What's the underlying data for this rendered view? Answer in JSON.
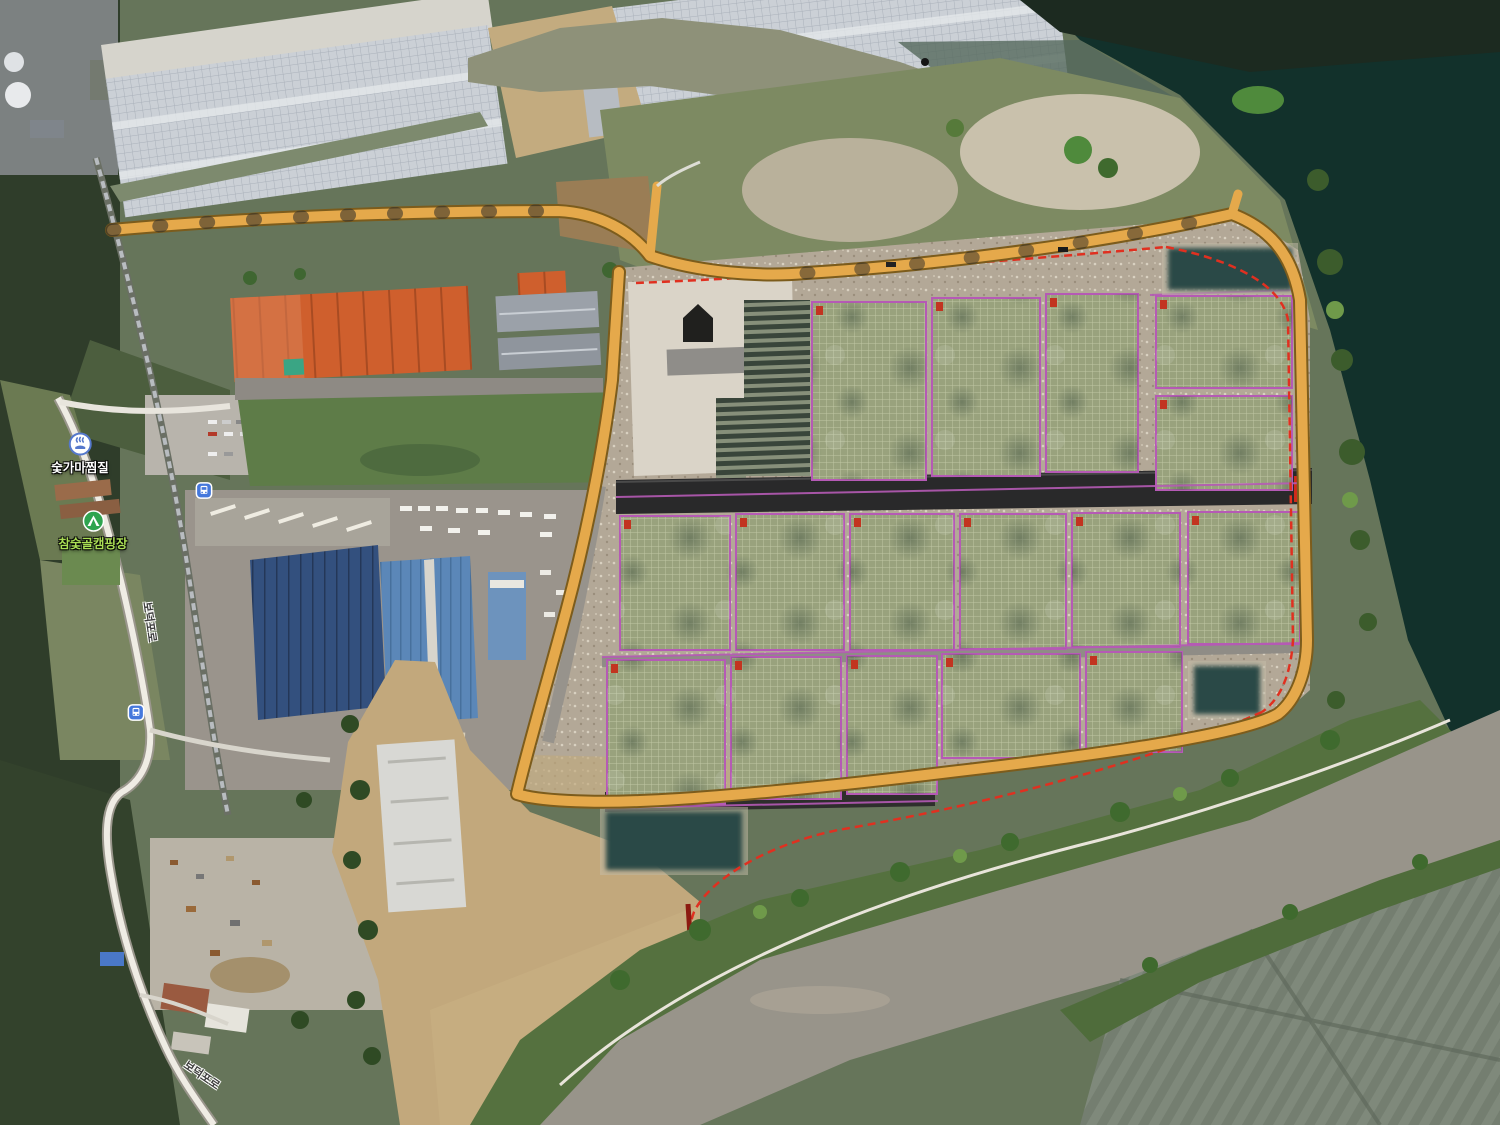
{
  "map": {
    "view": "satellite-orthophoto",
    "poi_labels": [
      {
        "id": "sauna",
        "label": "숯가마찜질",
        "icon": "sauna-icon"
      },
      {
        "id": "campground",
        "label": "참숯골캠핑장",
        "icon": "camping-icon"
      }
    ],
    "road_labels": [
      {
        "id": "road-label-1",
        "label": "보덕포로"
      },
      {
        "id": "road-label-2",
        "label": "보덕포로"
      }
    ],
    "transit": [
      {
        "id": "bus-stop-1",
        "type": "bus-stop"
      },
      {
        "id": "bus-stop-2",
        "type": "bus-stop"
      }
    ],
    "colors": {
      "poi_text": "#ffffff",
      "campground_text": "#aade55",
      "road_label_text": "#3d3d3d",
      "perimeter_road": "#e5a94b",
      "perimeter_road_casing": "#7c5c1c",
      "boundary_line": "#e03020",
      "boundary_spur": "#8c1a10",
      "lot_line": "#b55ab5",
      "marker": "#c23420",
      "redacted_fill": "#2b4a46",
      "bus_icon": "#4578dc",
      "sauna_icon": "#5578cc",
      "camping_icon": "#2fa44f",
      "water_dark": "#12312b",
      "water_muddy": "#98948a",
      "river_upper": "#8e9179"
    },
    "site_plan": {
      "greenhouse_blocks": [
        {
          "id": "T1",
          "x": 812,
          "y": 302,
          "w": 114,
          "h": 178
        },
        {
          "id": "T2",
          "x": 932,
          "y": 298,
          "w": 108,
          "h": 178
        },
        {
          "id": "T3",
          "x": 1046,
          "y": 294,
          "w": 92,
          "h": 178
        },
        {
          "id": "T4",
          "x": 1156,
          "y": 296,
          "w": 136,
          "h": 92
        },
        {
          "id": "T5",
          "x": 1156,
          "y": 396,
          "w": 136,
          "h": 94
        },
        {
          "id": "M1",
          "x": 620,
          "y": 516,
          "w": 110,
          "h": 134
        },
        {
          "id": "M2",
          "x": 736,
          "y": 514,
          "w": 108,
          "h": 136
        },
        {
          "id": "M3",
          "x": 850,
          "y": 514,
          "w": 104,
          "h": 136
        },
        {
          "id": "M4",
          "x": 960,
          "y": 514,
          "w": 106,
          "h": 135
        },
        {
          "id": "M5",
          "x": 1072,
          "y": 513,
          "w": 108,
          "h": 134
        },
        {
          "id": "M6",
          "x": 1188,
          "y": 512,
          "w": 112,
          "h": 132
        },
        {
          "id": "B1",
          "x": 607,
          "y": 660,
          "w": 118,
          "h": 144
        },
        {
          "id": "B2",
          "x": 731,
          "y": 657,
          "w": 110,
          "h": 142
        },
        {
          "id": "B3",
          "x": 847,
          "y": 656,
          "w": 90,
          "h": 138
        },
        {
          "id": "B4",
          "x": 942,
          "y": 654,
          "w": 138,
          "h": 104
        },
        {
          "id": "B5",
          "x": 1086,
          "y": 652,
          "w": 96,
          "h": 100
        }
      ],
      "redacted_areas": [
        {
          "id": "R1",
          "x": 1168,
          "y": 248,
          "w": 124,
          "h": 42
        },
        {
          "id": "R2",
          "x": 606,
          "y": 812,
          "w": 136,
          "h": 58
        },
        {
          "id": "R3",
          "x": 1194,
          "y": 666,
          "w": 66,
          "h": 48
        }
      ]
    }
  }
}
